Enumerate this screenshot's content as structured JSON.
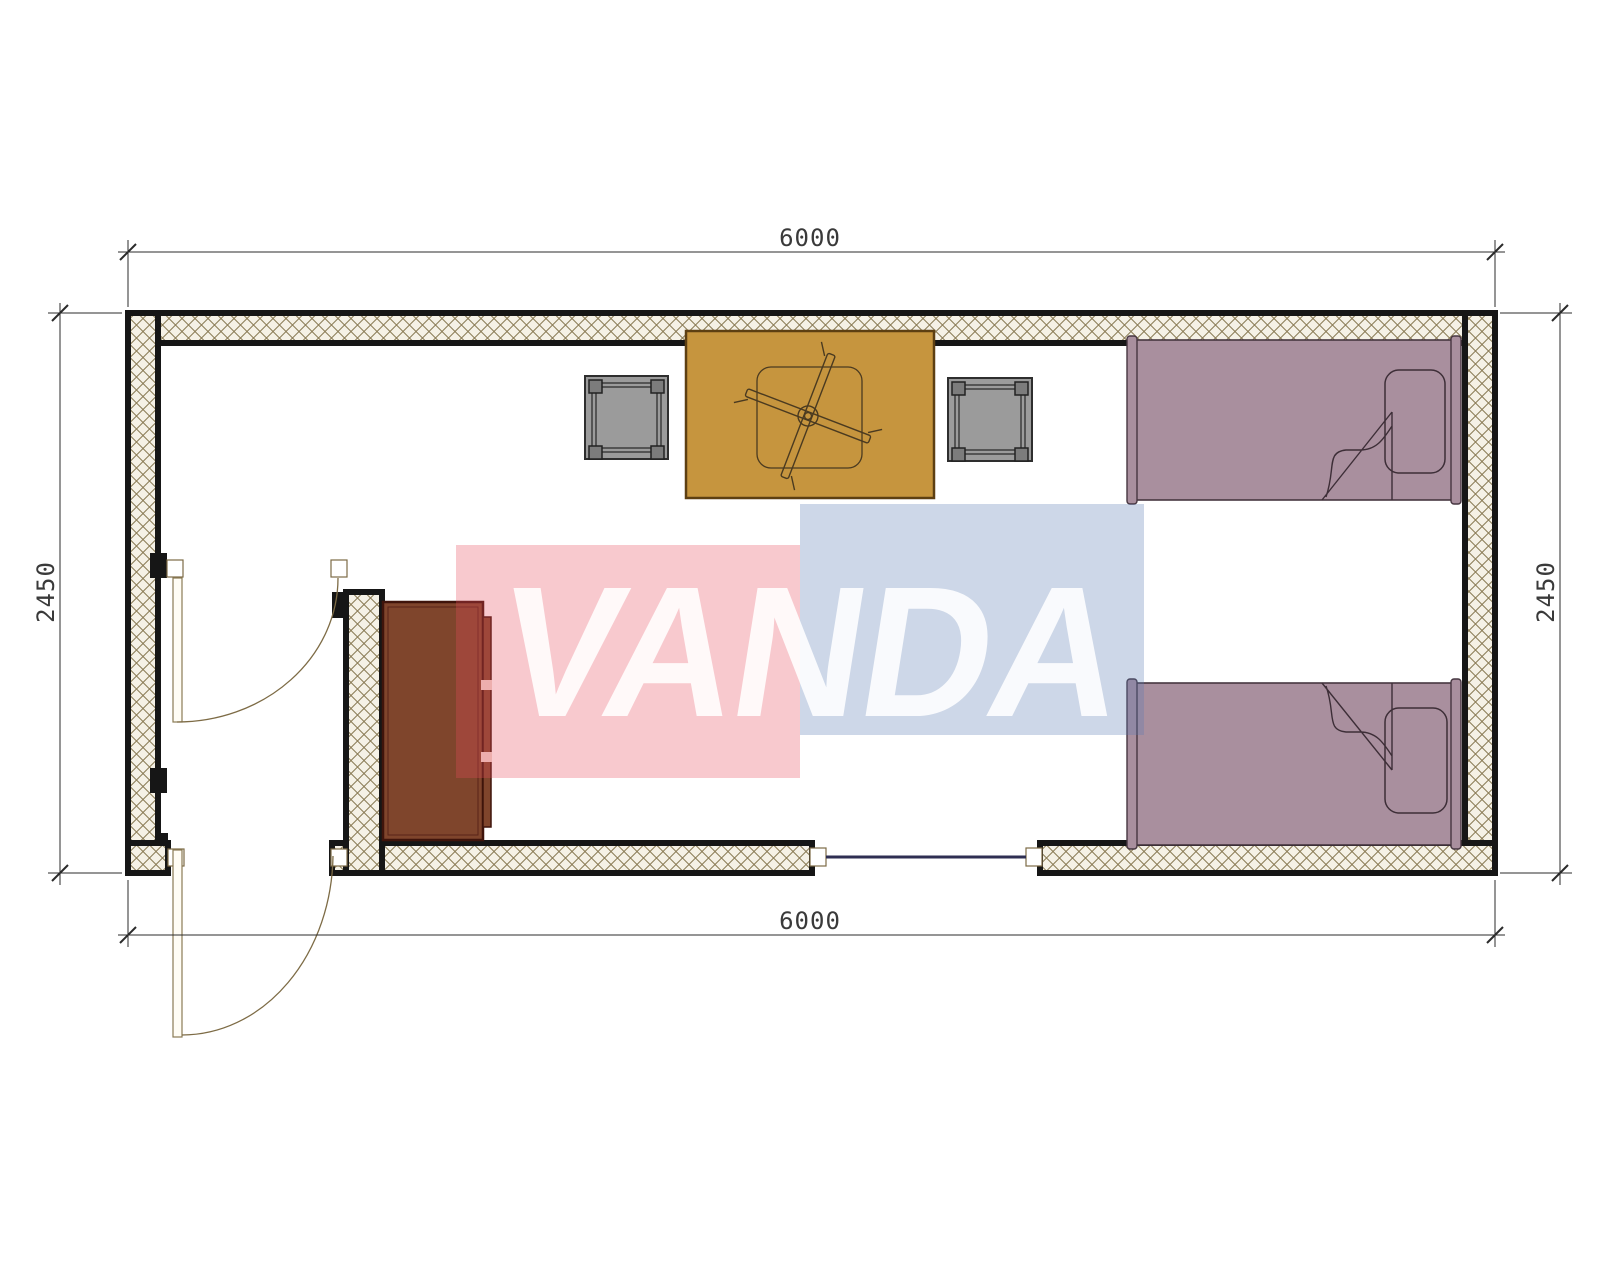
{
  "page": {
    "title": "Floor plan"
  },
  "dims": {
    "top": "6000",
    "bottom": "6000",
    "left": "2450",
    "right": "2450"
  },
  "watermark": {
    "text": "VANDA",
    "red_fill": "rgba(231,76,94,0.30)",
    "blue_fill": "rgba(88,122,179,0.30)",
    "text_fill": "rgba(255,255,255,0.88)"
  },
  "colors": {
    "wall_hatch_bg": "#f5f1e6",
    "wall_hatch_line": "#8a7b55",
    "wall_border": "#161616",
    "table_fill": "#c6953e",
    "table_border": "#5d3f12",
    "stool_fill": "#9b9b9b",
    "stool_leg": "#7c7c7c",
    "bed_fill": "#a98f9e",
    "bed_line": "#463640",
    "cabinet_fill": "#7f452c",
    "cabinet_border": "#3f140b",
    "window_line": "#2e2e52",
    "door_line": "#7d6b45",
    "dim_line": "#2b2b2b"
  },
  "furniture": {
    "items": [
      "dining-table",
      "ceiling-fan",
      "stool",
      "stool",
      "single-bed",
      "single-bed",
      "cabinet"
    ]
  }
}
